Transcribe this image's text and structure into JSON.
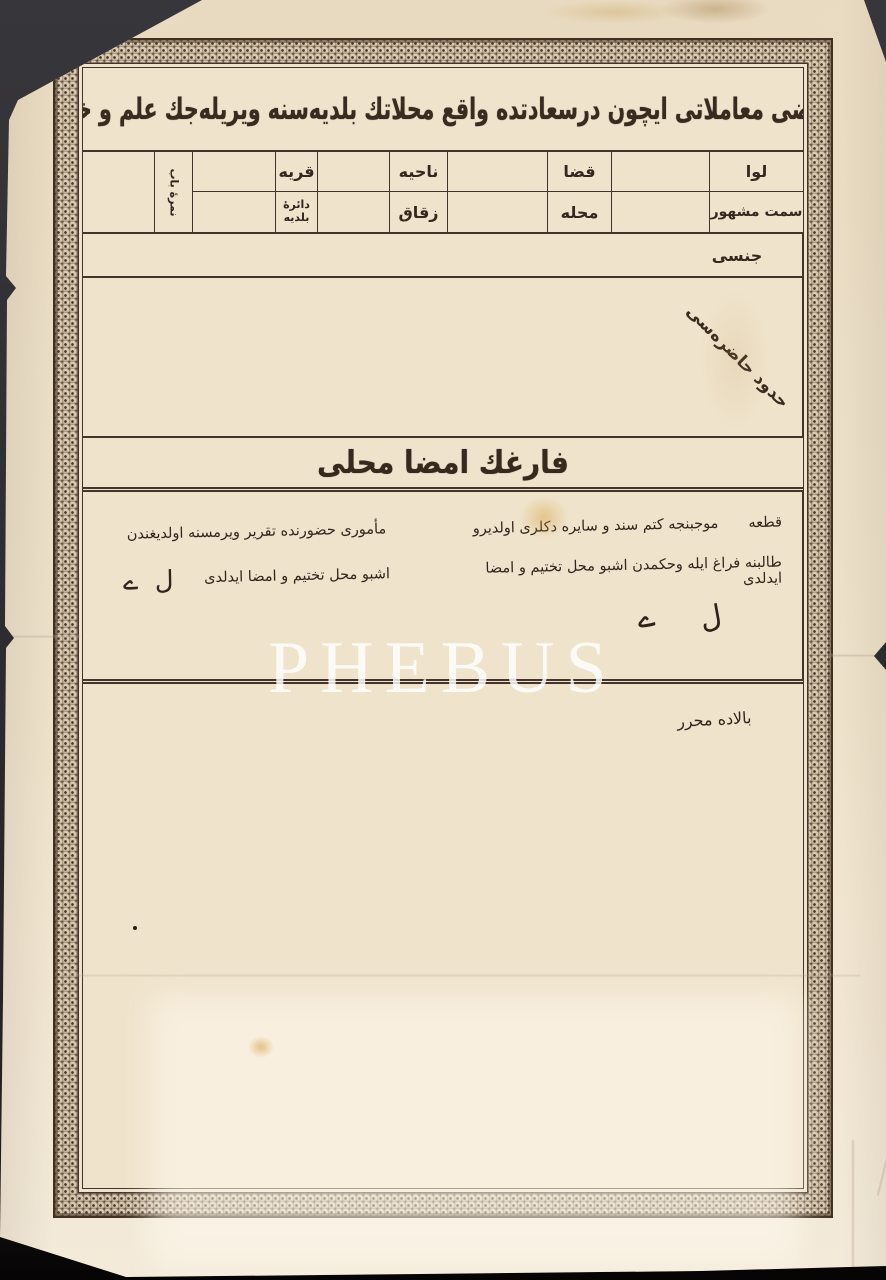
{
  "watermark": {
    "text": "PHEBUS"
  },
  "colors": {
    "background": "#2e2d30",
    "paper": "#efe3cb",
    "ink": "#32241c",
    "rule_line": "#44332a",
    "ornament": "#4a382e",
    "watermark_color": "rgba(255,255,255,0.82)"
  },
  "doc": {
    "title_calligraphy": "هر نوع املاك و اراضى معاملاتى ايچون درسعادتده واقع محلاتك بلديه‌سنه ويريله‌جك علم و خبره مخصوص ورقه",
    "table": {
      "liva": "لوا",
      "kaza": "قضا",
      "nahiye": "ناحيه",
      "karye": "قريه",
      "semt": "سمت مشهور",
      "mahalle": "محله",
      "zukak": "زقاق",
      "belediye_line1": "دائرهٔ",
      "belediye_line2": "بلديه",
      "kapi_numarasi": "نمرهٔ باب"
    },
    "cins_label": "جنسى",
    "hudud_label": "حدود حاضره‌سى",
    "imza_band": "فارغك امضا محلى",
    "right_note": {
      "kita": "قطعه",
      "line1": "موجبنجه كتم سند و سايره دكلرى اولديرو",
      "line2": "طالبنه فراغ ايله وحكمدن اشبو محل تختيم و امضا ايدلدى",
      "mark1": "ے",
      "mark2": "ل"
    },
    "left_note": {
      "line1": "مأمورى حضورنده تقرير ويرمسنه اولديغندن",
      "line2": "اشبو محل تختيم و امضا ايدلدى",
      "mark1": "ے",
      "mark2": "ل"
    },
    "balada": "بالاده محرر"
  }
}
